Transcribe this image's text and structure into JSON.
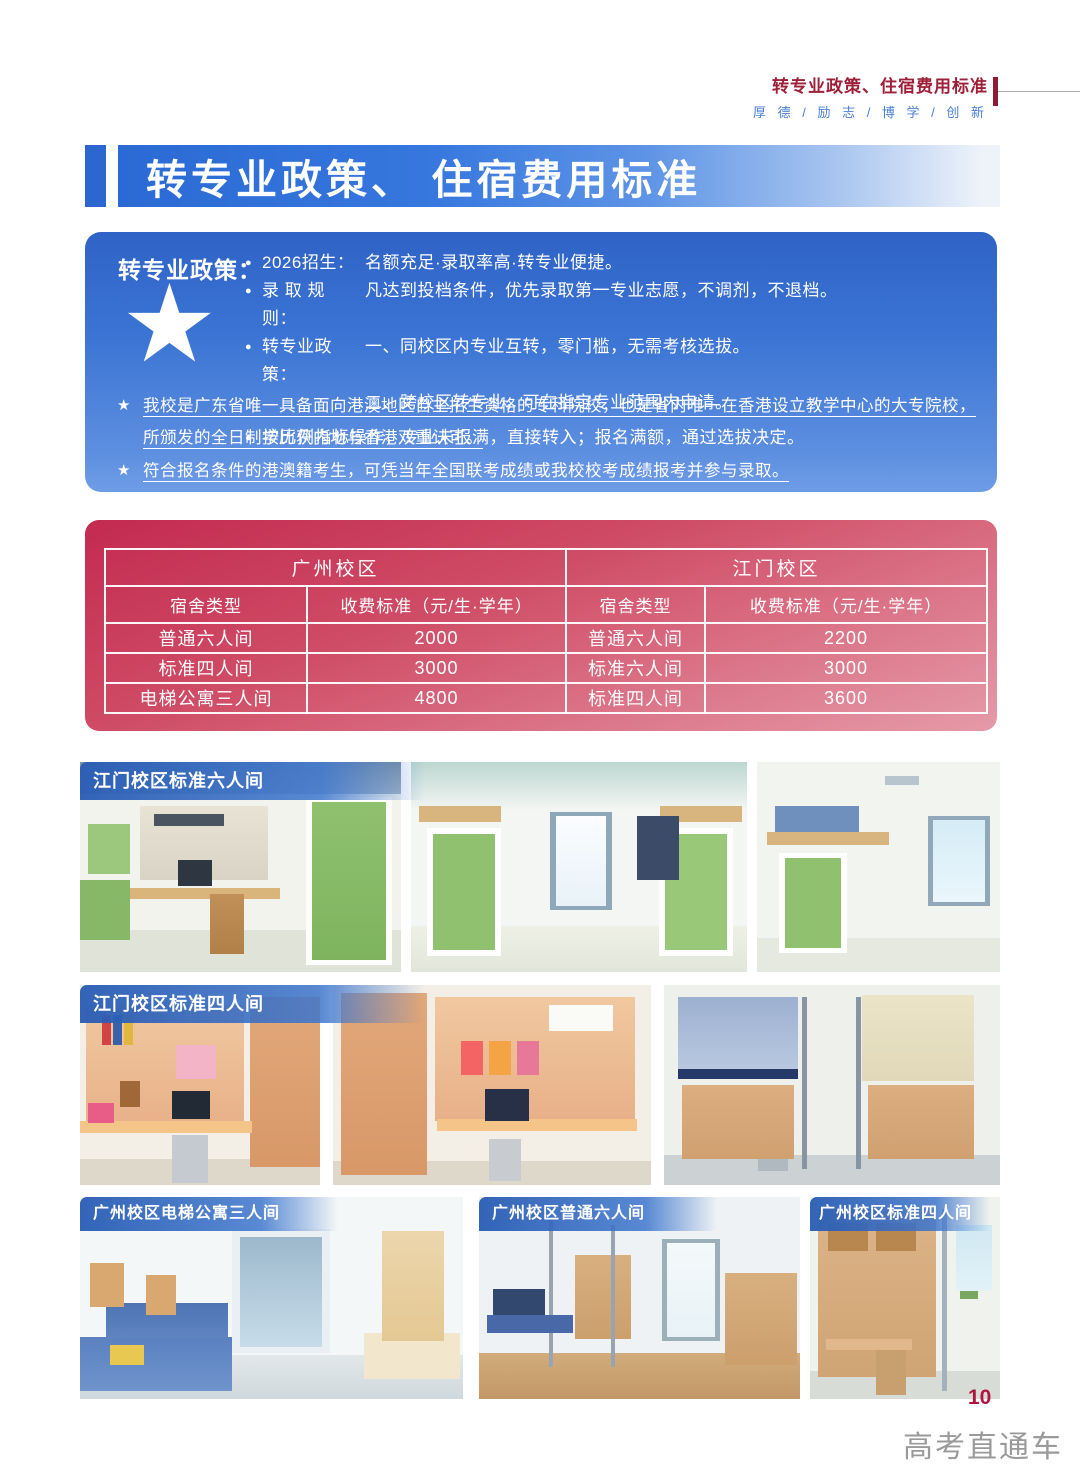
{
  "header": {
    "doc_title": "转专业政策、住宿费用标准",
    "slogan": "厚 德 / 励 志 / 博 学 / 创 新"
  },
  "banner": {
    "title": "转专业政策、 住宿费用标准"
  },
  "policy_box": {
    "label": "转专业政策：",
    "star_icon": "★",
    "bullets": [
      {
        "marker": "●",
        "head": "2026招生：",
        "text": "名额充足·录取率高·转专业便捷。"
      },
      {
        "marker": "●",
        "head": "录 取 规 则：",
        "text": "凡达到投档条件，优先录取第一专业志愿，不调剂，不退档。"
      },
      {
        "marker": "●",
        "head": "转专业政策：",
        "text": "一、同校区内专业互转，零门槛，无需考核选拔。"
      },
      {
        "marker": "",
        "head": "",
        "text": "二、跨校区转专业，可在指定专业范围内申请。"
      },
      {
        "marker": "●",
        "head": "",
        "text": "按比例指标操作，专业未报满，直接转入；报名满额，通过选拔决定。"
      }
    ],
    "notes": [
      {
        "marker": "★",
        "text": "我校是广东省唯一具备面向港澳地区自主招生资格的专科院校，也是省内唯一在香港设立教学中心的大专院校，所颁发的全日制学历获内地与香港双重认可。"
      },
      {
        "marker": "★",
        "text": "符合报名条件的港澳籍考生，可凭当年全国联考成绩或我校校考成绩报考并参与录取。"
      }
    ]
  },
  "fee_table": {
    "campuses": [
      {
        "name": "广州校区",
        "columns": [
          "宿舍类型",
          "收费标准（元/生·学年）"
        ],
        "rows": [
          {
            "type": "普通六人间",
            "fee": "2000"
          },
          {
            "type": "标准四人间",
            "fee": "3000"
          },
          {
            "type": "电梯公寓三人间",
            "fee": "4800"
          }
        ]
      },
      {
        "name": "江门校区",
        "columns": [
          "宿舍类型",
          "收费标准（元/生·学年）"
        ],
        "rows": [
          {
            "type": "普通六人间",
            "fee": "2200"
          },
          {
            "type": "标准六人间",
            "fee": "3000"
          },
          {
            "type": "标准四人间",
            "fee": "3600"
          }
        ]
      }
    ]
  },
  "photos": {
    "row1_label": "江门校区标准六人间",
    "row2_label": "江门校区标准四人间",
    "row3_labels": [
      "广州校区电梯公寓三人间",
      "广州校区普通六人间",
      "广州校区标准四人间"
    ]
  },
  "footer": {
    "page_number": "10",
    "watermark": "高考直通车"
  },
  "colors": {
    "header_red": "#9e1f38",
    "slogan_blue": "#4a7ed2",
    "title_banner_blue": "#2b6ad4",
    "policy_box_blue": "#3b74d4",
    "fee_panel_red": "#c32a50",
    "photo_label_blue": "#285cb4",
    "page_number_red": "#b01540",
    "watermark_gray": "#9a9a9a"
  }
}
